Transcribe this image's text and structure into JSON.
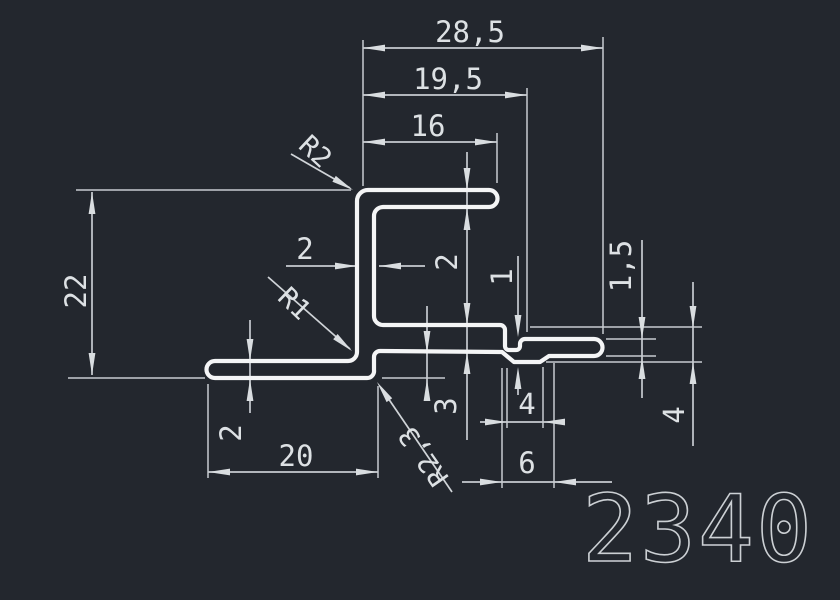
{
  "drawing": {
    "part_number": "2340",
    "dimensions": {
      "overall_width": "28,5",
      "upper_width": "19,5",
      "top_flange_length": "16",
      "overall_height": "22",
      "web_thickness": "2",
      "top_flange_thickness": "2",
      "mid_flange_thickness": "3",
      "groove_offset": "1",
      "end_flange_thickness": "1,5",
      "end_step_height": "4",
      "notch_width": "4",
      "notch_span": "6",
      "bottom_flange_length": "20",
      "bottom_flange_thickness": "2"
    },
    "radii": {
      "top_corner": "R2",
      "bottom_inner_corner": "R1",
      "bottom_outer_corner": "R2,3"
    },
    "colors": {
      "background": "#23272e",
      "profile_line": "#f4f5f6",
      "dimension_line": "#c7cbd0",
      "dimension_text": "#dde1e4",
      "part_number_text": "#ccd0d4"
    }
  }
}
